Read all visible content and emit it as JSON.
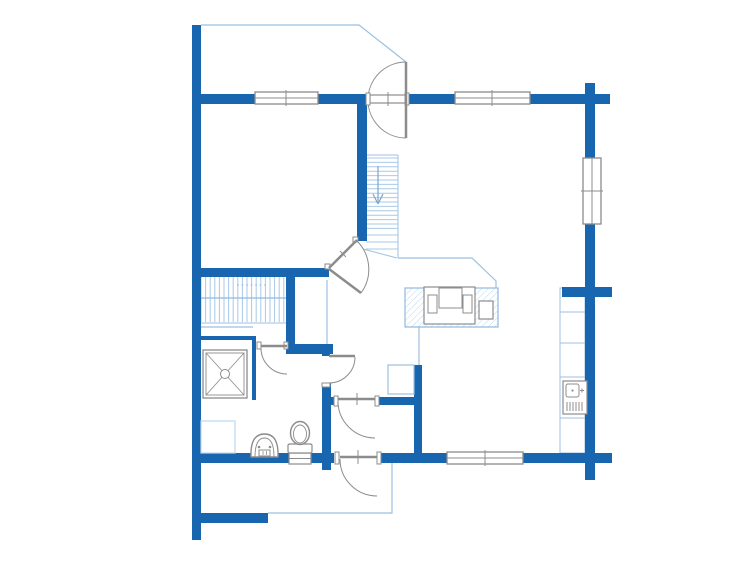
{
  "app": {
    "type": "architectural-floor-plan",
    "content": "ground-floor-layout",
    "text_labels": []
  },
  "canvas": {
    "w": 755,
    "h": 566,
    "bg": "#ffffff"
  },
  "colors": {
    "wall": "#1966b0",
    "thin": "#9cc1e0",
    "lighter": "#bcd7ec",
    "tread": "#a9c9e7",
    "mid": "#8fb9e0",
    "gray": "#8c8c8c",
    "white": "#ffffff",
    "arrow": "#7ba6cf"
  },
  "walls": [
    [
      192,
      25,
      9,
      515,
      "wall-left-outer"
    ],
    [
      201,
      94,
      54,
      10,
      "wall-top-a"
    ],
    [
      318,
      94,
      52,
      10,
      "wall-top-b"
    ],
    [
      406,
      94,
      49,
      10,
      "wall-top-c"
    ],
    [
      530,
      94,
      80,
      10,
      "wall-top-d"
    ],
    [
      585,
      83,
      10,
      11,
      "wall-right-stub-top"
    ],
    [
      585,
      104,
      10,
      56,
      "wall-right-a"
    ],
    [
      585,
      223,
      10,
      64,
      "wall-right-b"
    ],
    [
      562,
      287,
      50,
      10,
      "wall-joint-east"
    ],
    [
      585,
      297,
      10,
      156,
      "wall-right-c"
    ],
    [
      585,
      463,
      10,
      17,
      "wall-right-stub-bottom"
    ],
    [
      192,
      453,
      142,
      10,
      "wall-bottom-a"
    ],
    [
      377,
      453,
      71,
      10,
      "wall-bottom-b"
    ],
    [
      523,
      453,
      89,
      10,
      "wall-bottom-c"
    ],
    [
      192,
      268,
      137,
      9,
      "wall-bedroom-south"
    ],
    [
      357,
      104,
      10,
      137,
      "wall-stairs-west"
    ],
    [
      286,
      271,
      9,
      74,
      "wall-closet-west"
    ],
    [
      286,
      344,
      47,
      10,
      "wall-washroom-north"
    ],
    [
      322,
      352,
      8,
      4,
      "wall-closet-jamb"
    ],
    [
      322,
      383,
      9,
      87,
      "wall-hall-west-lower"
    ],
    [
      330,
      397,
      8,
      8,
      "wall-vestibule-south-a"
    ],
    [
      375,
      397,
      43,
      8,
      "wall-vestibule-south-b"
    ],
    [
      414,
      365,
      8,
      88,
      "wall-vestibule-east"
    ],
    [
      198,
      513,
      70,
      10,
      "wall-porch-south"
    ]
  ],
  "thin_walls": [
    [
      195,
      336,
      58,
      4,
      "shower-wall-north"
    ],
    [
      252,
      336,
      4,
      64,
      "shower-wall-east"
    ]
  ],
  "outlines": [
    {
      "name": "porch-top-edge",
      "pts": [
        [
          201,
          25
        ],
        [
          359,
          25
        ],
        [
          406,
          62
        ]
      ]
    },
    {
      "name": "porch-bottom-edge",
      "pts": [
        [
          268,
          513
        ],
        [
          392,
          513
        ],
        [
          392,
          463
        ]
      ]
    },
    {
      "name": "loft-edge",
      "pts": [
        [
          398,
          258
        ],
        [
          472,
          258
        ],
        [
          496,
          281
        ],
        [
          496,
          288
        ]
      ]
    },
    {
      "name": "kitchen-floor-edge",
      "pts": [
        [
          419,
          327
        ],
        [
          419,
          365
        ]
      ]
    },
    {
      "name": "closet-front-line",
      "pts": [
        [
          327,
          280
        ],
        [
          327,
          344
        ]
      ]
    },
    {
      "name": "shower-area-edge",
      "pts": [
        [
          197,
          327
        ],
        [
          253,
          327
        ]
      ]
    }
  ],
  "stairs_upper": {
    "x1": 366,
    "x2": 398,
    "top_y": 155,
    "edge": [
      398,
      155,
      398,
      258
    ],
    "tread_y0": 158,
    "tread_step": 4.4,
    "tread_count": 17,
    "lower_treads": [
      235,
      242,
      249
    ],
    "cut": [
      363,
      249,
      397,
      258
    ],
    "arrow": {
      "x": 378,
      "y1": 166,
      "y2": 202,
      "head": [
        [
          373,
          194
        ],
        [
          383,
          194
        ],
        [
          378,
          204
        ]
      ]
    }
  },
  "stairs_lower": {
    "y1": 277,
    "y2": 322,
    "x0": 201,
    "step": 4.6,
    "count": 19,
    "mid_line": [
      201,
      298,
      286,
      298
    ],
    "dash_line": [
      237,
      285,
      267,
      285
    ],
    "bottom_line": [
      201,
      323,
      286,
      323
    ]
  },
  "kitchen": {
    "counter": [
      405,
      288,
      93,
      39
    ],
    "sink_unit": [
      424,
      287,
      51,
      37
    ],
    "sink_center": [
      439,
      288,
      23,
      20
    ],
    "sink_left": [
      428,
      295,
      9,
      18
    ],
    "sink_right": [
      463,
      295,
      9,
      18
    ],
    "hob": [
      479,
      301,
      14,
      18
    ],
    "cabinets": [
      560,
      288,
      25,
      165
    ],
    "cabinet_divs": [
      312,
      343,
      377,
      418
    ],
    "stove": {
      "box": [
        563,
        381,
        24,
        33
      ],
      "oven": [
        566,
        384,
        13,
        13
      ],
      "dot": [
        572.5,
        390.5
      ],
      "plus": [
        582,
        390.5
      ],
      "vent": {
        "x0": 567,
        "step": 3,
        "count": 6,
        "y1": 402,
        "y2": 411
      }
    }
  },
  "bathroom": {
    "shower_outer": [
      203,
      350,
      44,
      48
    ],
    "shower_inner": [
      206,
      353,
      38,
      42
    ],
    "shower_circle": [
      225,
      374,
      4.5
    ],
    "bench": [
      201,
      421,
      34,
      32
    ],
    "toilet": {
      "base": [
        289,
        453,
        22,
        11
      ],
      "base_mid_y": 458.5,
      "tank": [
        288,
        444,
        24,
        9
      ],
      "bowl": [
        300,
        433,
        9.5,
        11.5
      ],
      "bowl_inner": [
        300,
        434,
        6.5,
        9
      ]
    },
    "basin": {
      "outer": "M251,457 Q250,434 264.5,434 Q279,434 278,457 Z",
      "inner": "M255,457 Q255,438 264.5,438 Q274,438 274,457",
      "dots": [
        [
          259,
          447
        ],
        [
          270,
          447
        ]
      ],
      "mouth": [
        259,
        450,
        11,
        6
      ],
      "mouth_ticks": [
        263,
        266.5
      ]
    }
  },
  "closet_box": [
    388,
    365,
    26,
    29
  ],
  "windows": [
    {
      "name": "window-top-left",
      "rect": [
        255,
        92,
        63,
        12
      ],
      "orient": "h",
      "ticks": [
        286
      ]
    },
    {
      "name": "window-top-right",
      "rect": [
        455,
        92,
        75,
        12
      ],
      "orient": "h",
      "ticks": [
        492
      ]
    },
    {
      "name": "window-right",
      "rect": [
        583,
        158,
        18,
        66
      ],
      "orient": "v",
      "ticks": [
        191
      ]
    },
    {
      "name": "window-bottom",
      "rect": [
        447,
        452,
        76,
        12
      ],
      "orient": "h",
      "ticks": [
        485
      ]
    }
  ],
  "doors": [
    {
      "name": "entry-door-north",
      "jambs": [
        [
          366,
          93,
          4,
          12
        ],
        [
          405,
          93,
          4,
          12
        ]
      ],
      "threshold": [
        370,
        95,
        36,
        8
      ],
      "tick": [
        388,
        92,
        388,
        106
      ],
      "leaf": [
        406,
        62,
        406,
        138
      ],
      "arc": "M406,62 A38,38 0 0 0 406,138"
    },
    {
      "name": "door-living-diagonal",
      "jambs": [
        [
          325,
          264,
          5,
          5
        ],
        [
          353,
          237,
          5,
          5
        ]
      ],
      "tick": [
        340,
        251,
        346,
        257
      ],
      "leaf": [
        329,
        268,
        357,
        240
      ],
      "leaf_open": [
        329,
        269,
        361,
        293
      ],
      "arc": "M357,241 A40,40 0 0 1 361,293"
    },
    {
      "name": "door-washroom",
      "jambs": [
        [
          257,
          342,
          4,
          7
        ],
        [
          284,
          342,
          4,
          7
        ]
      ],
      "leaf": [
        261,
        346,
        287,
        346
      ],
      "arc": "M261,348 A26,26 0 0 0 287,374"
    },
    {
      "name": "door-closet",
      "jambs": [
        [
          322,
          383,
          8,
          4
        ]
      ],
      "leaf": [
        329,
        356,
        355,
        356
      ],
      "arc": "M355,357 A26,26 0 0 1 329,383"
    },
    {
      "name": "door-vestibule-inner",
      "jambs": [
        [
          334,
          396,
          4,
          10
        ],
        [
          375,
          396,
          4,
          10
        ]
      ],
      "tick": [
        357,
        393,
        357,
        405
      ],
      "leaf": [
        338,
        399,
        375,
        399
      ],
      "arc": "M338,401 A37,37 0 0 0 375,438"
    },
    {
      "name": "door-entry-south",
      "jambs": [
        [
          335,
          452,
          4,
          12
        ],
        [
          377,
          452,
          4,
          12
        ]
      ],
      "tick": [
        358,
        450,
        358,
        464
      ],
      "leaf": [
        340,
        457,
        377,
        457
      ],
      "arc": "M340,459 A37,37 0 0 0 377,496"
    }
  ]
}
